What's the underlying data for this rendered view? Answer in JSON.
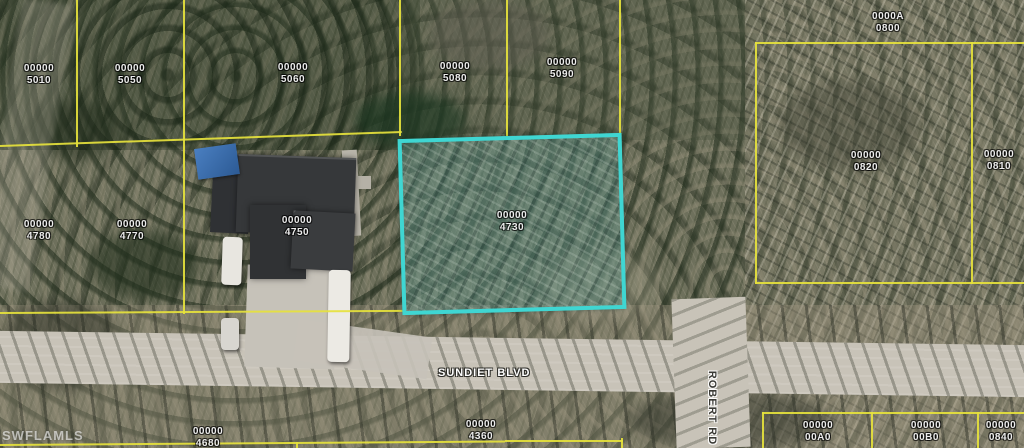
{
  "map": {
    "watermark": "SWFLAMLS",
    "highlight_color": "#3fd6d2",
    "boundary_color": "#e6e23c",
    "highlighted_parcel_label": "00000\n4730",
    "streets": [
      {
        "name": "SUNDIET BLVD"
      },
      {
        "name": "ROBERT RD"
      }
    ],
    "parcels": [
      {
        "label": "00000\n5010"
      },
      {
        "label": "00000\n5050"
      },
      {
        "label": "00000\n5060"
      },
      {
        "label": "00000\n5080"
      },
      {
        "label": "00000\n5090"
      },
      {
        "label": "0000A\n0800"
      },
      {
        "label": "00000\n0820"
      },
      {
        "label": "00000\n0810"
      },
      {
        "label": "00000\n4780"
      },
      {
        "label": "00000\n4770"
      },
      {
        "label": "00000\n4750"
      },
      {
        "label": "00000\n4730"
      },
      {
        "label": "00000\n4680"
      },
      {
        "label": "00000\n4360"
      },
      {
        "label": "00000\n00A0"
      },
      {
        "label": "00000\n00B0"
      },
      {
        "label": "00000\n0840"
      }
    ]
  }
}
